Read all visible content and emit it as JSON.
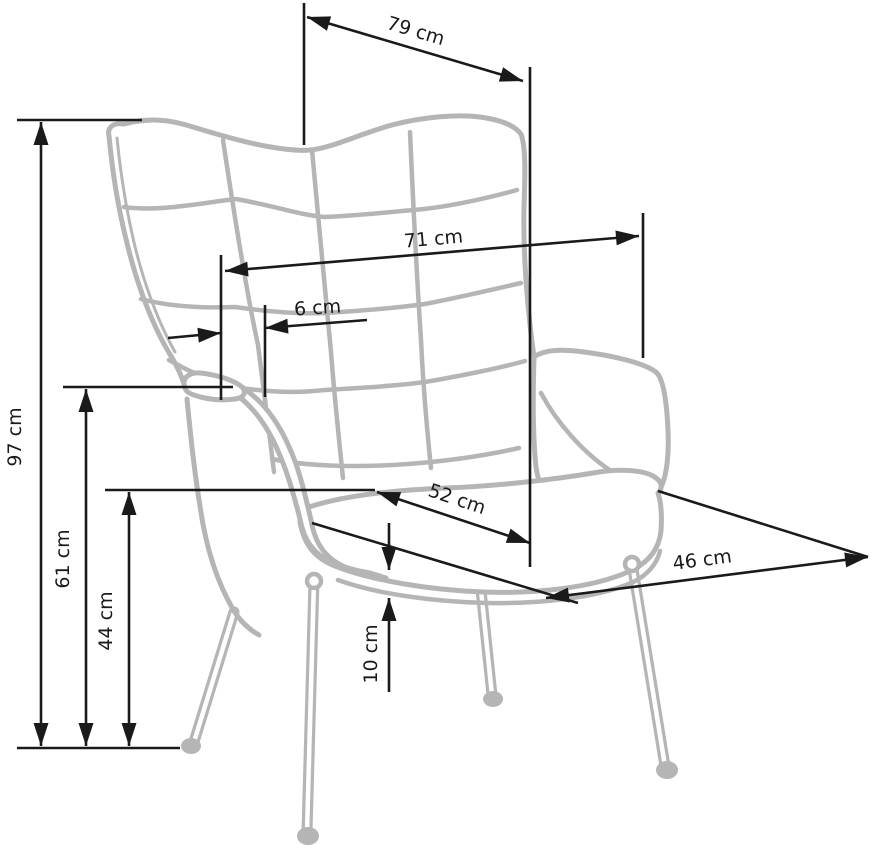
{
  "diagram": {
    "type": "furniture-dimension-diagram",
    "subject": "wingback armchair line drawing, front three-quarter view",
    "unit": "cm"
  },
  "dimensions": {
    "d79": {
      "label": "79 cm",
      "value": 79,
      "unit": "cm"
    },
    "d71": {
      "label": "71 cm",
      "value": 71,
      "unit": "cm"
    },
    "d6": {
      "label": "6 cm",
      "value": 6,
      "unit": "cm"
    },
    "d97": {
      "label": "97 cm",
      "value": 97,
      "unit": "cm"
    },
    "d61": {
      "label": "61 cm",
      "value": 61,
      "unit": "cm"
    },
    "d44": {
      "label": "44 cm",
      "value": 44,
      "unit": "cm"
    },
    "d10": {
      "label": "10 cm",
      "value": 10,
      "unit": "cm"
    },
    "d52": {
      "label": "52 cm",
      "value": 52,
      "unit": "cm"
    },
    "d46": {
      "label": "46 cm",
      "value": 46,
      "unit": "cm"
    }
  },
  "colors": {
    "chair_outline": "#b5b5b5",
    "dimension_lines": "#1a1a1a",
    "background": "#ffffff"
  }
}
